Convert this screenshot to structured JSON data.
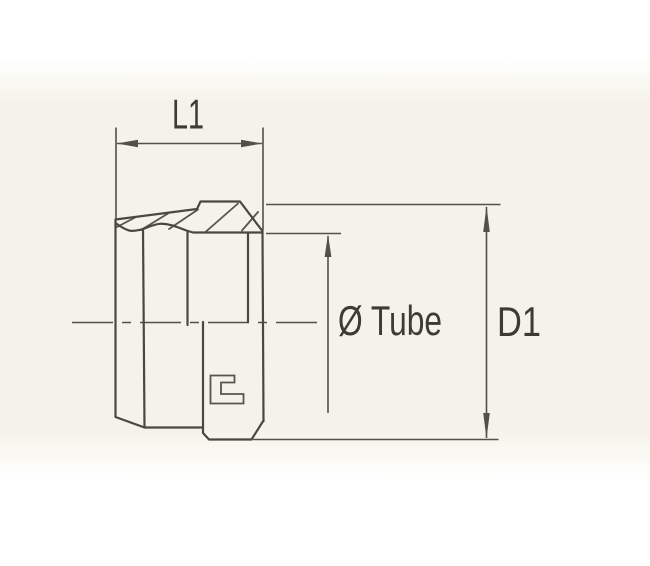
{
  "labels": {
    "l1": "L1",
    "tube": "Ø Tube",
    "d1": "D1"
  },
  "colors": {
    "outline": "#4a4740",
    "dimension": "#53504a",
    "text": "#3d3b34",
    "paper_tint": "#f5f3e9",
    "page": "#ffffff"
  }
}
